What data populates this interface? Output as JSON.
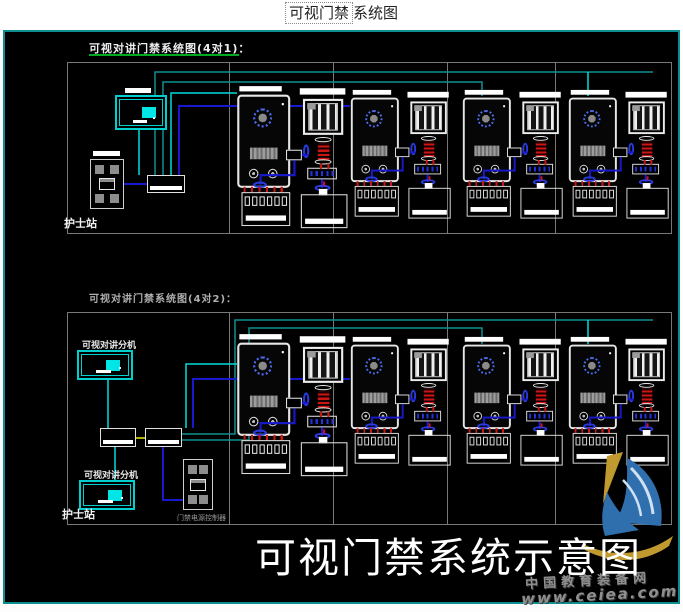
{
  "header": {
    "title_boxed": "可视门禁",
    "title_rest": "系统图"
  },
  "top_diagram": {
    "label": "可视对讲门禁系统图(4对1)：",
    "station_label": "护士站"
  },
  "bottom_diagram": {
    "label": "可视对讲门禁系统图(4对2)：",
    "station_label": "护士站",
    "monitor_top_label": "可视对讲分机",
    "monitor_bottom_label": "可视对讲分机",
    "controller_caption": "门禁电源控制器"
  },
  "overlay": {
    "big_title": "可视门禁系统示意图"
  },
  "watermark": {
    "site_name": "中国教育装备网",
    "site_url": "www.ceiea.com"
  },
  "colors": {
    "canvas_bg": "#000000",
    "canvas_border": "#0e8f8f",
    "frame_gray": "#787878",
    "wire_teal": "#0d8f8f",
    "wire_cyan": "#00dcdc",
    "wire_blue": "#1818cf",
    "wire_red": "#cc1515",
    "wire_yellow": "#b0b000",
    "monitor_cyan": "#00cfcf",
    "screen_cyan": "#00e5e5",
    "label_green": "#00aa22",
    "cam_blue": "#4b6cf0",
    "watermark_gray": "#8f8f8f",
    "logo_gold": "#c09a2e",
    "logo_blue": "#2f6fae"
  }
}
